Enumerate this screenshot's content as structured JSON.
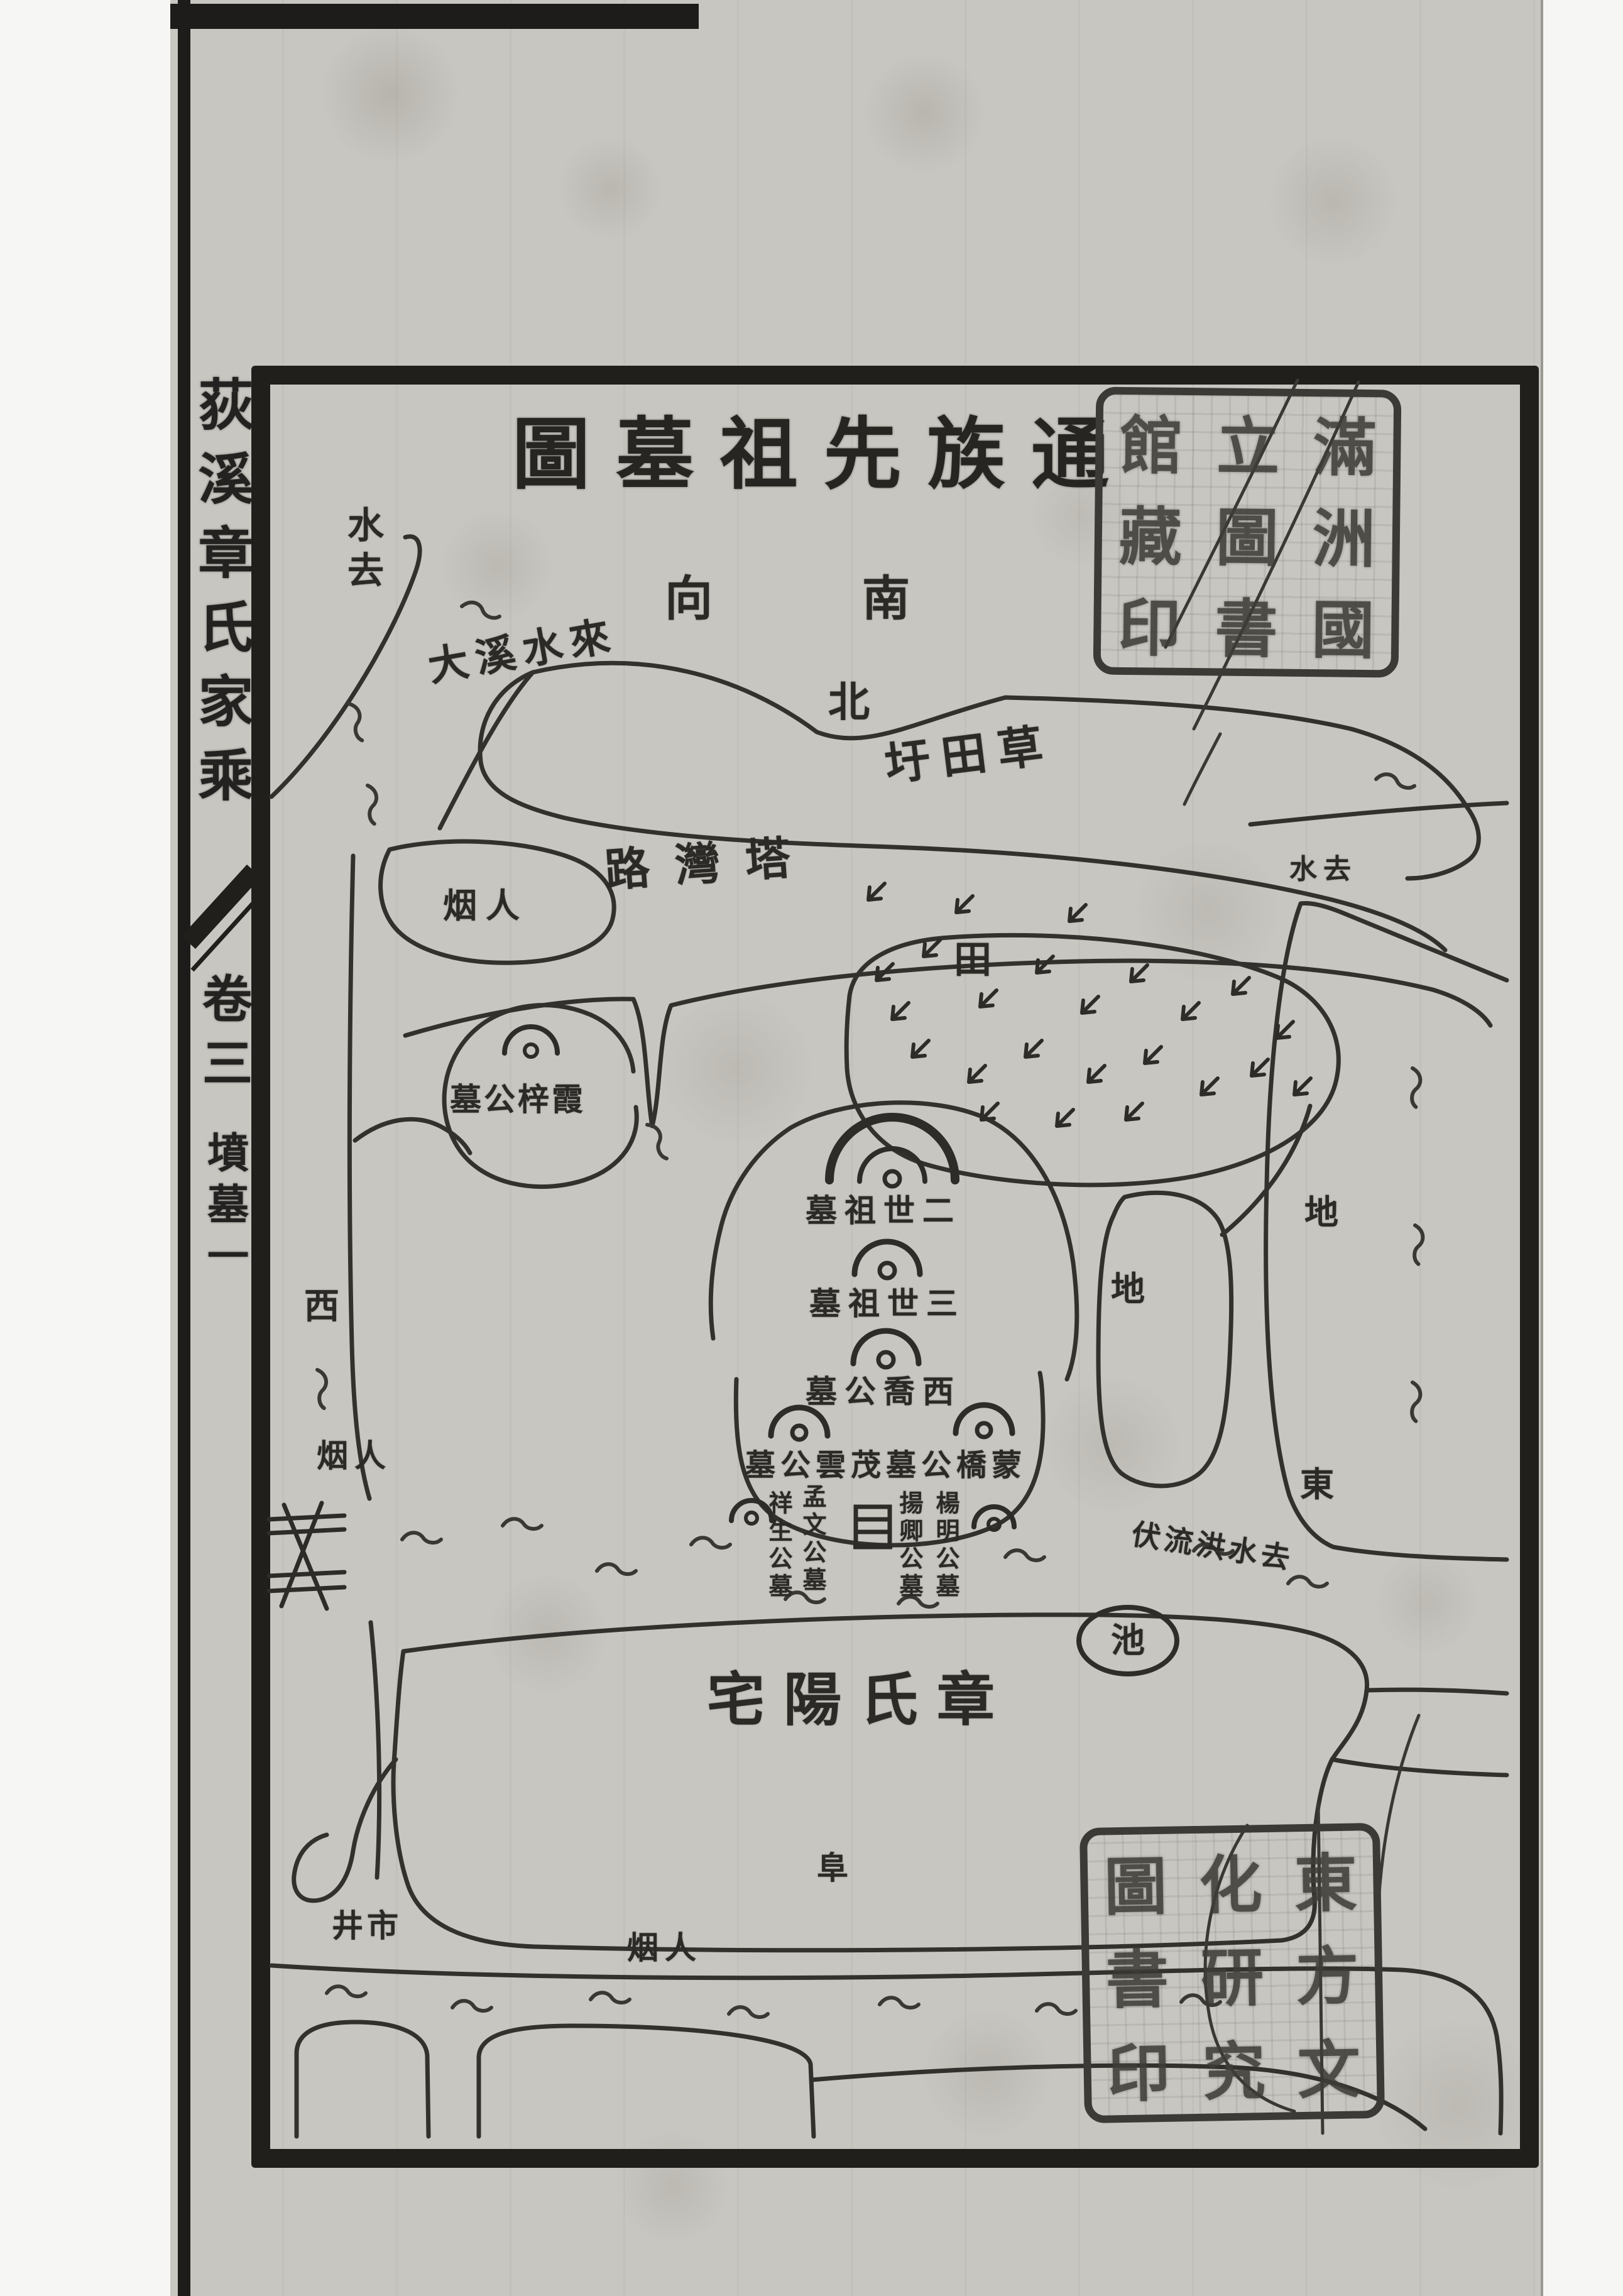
{
  "book": {
    "spine_title": "荻溪章氏家乘",
    "spine_volume": "卷三",
    "spine_section": "墳墓一"
  },
  "map": {
    "title_display": "圖墓祖先族通",
    "title_chars": [
      "圖",
      "墓",
      "祖",
      "先",
      "族",
      "通"
    ],
    "orientation": {
      "facing": "向",
      "south": "南",
      "north": "北"
    },
    "waterways": {
      "creek_inflow": "大溪水來",
      "water_out_left": "水去",
      "water_out_right": "水去",
      "flood_outflow": "伏流洪水去"
    },
    "places": {
      "polder": "圩田草",
      "road": "路灣塔",
      "field": "田",
      "settlement": "烟人",
      "west": "西",
      "east": "東",
      "land": "地",
      "pond": "池",
      "residence": "宅陽氏章",
      "market": "井市",
      "mound": "阜"
    },
    "tombs": {
      "xiazi": "墓公梓霞",
      "gen2": "墓祖世二",
      "gen3": "墓祖世三",
      "xiqiao": "墓公喬西",
      "maoyun": "墓公雲茂",
      "mengqiao": "墓公橋蒙",
      "mengwen": "孟文公墓",
      "xiangsheng": "祥生公墓",
      "yangming": "楊明公墓",
      "yangqing": "揚卿公墓"
    }
  },
  "seals": {
    "top": {
      "chars": [
        "滿",
        "洲",
        "國",
        "立",
        "圖",
        "書",
        "館",
        "藏",
        "印"
      ]
    },
    "bottom": {
      "chars": [
        "東",
        "方",
        "文",
        "化",
        "研",
        "究",
        "圖",
        "書",
        "印"
      ]
    }
  },
  "colors": {
    "paper": "#c8c6c0",
    "ink": "#2b2a26",
    "frame": "#201f1c"
  }
}
